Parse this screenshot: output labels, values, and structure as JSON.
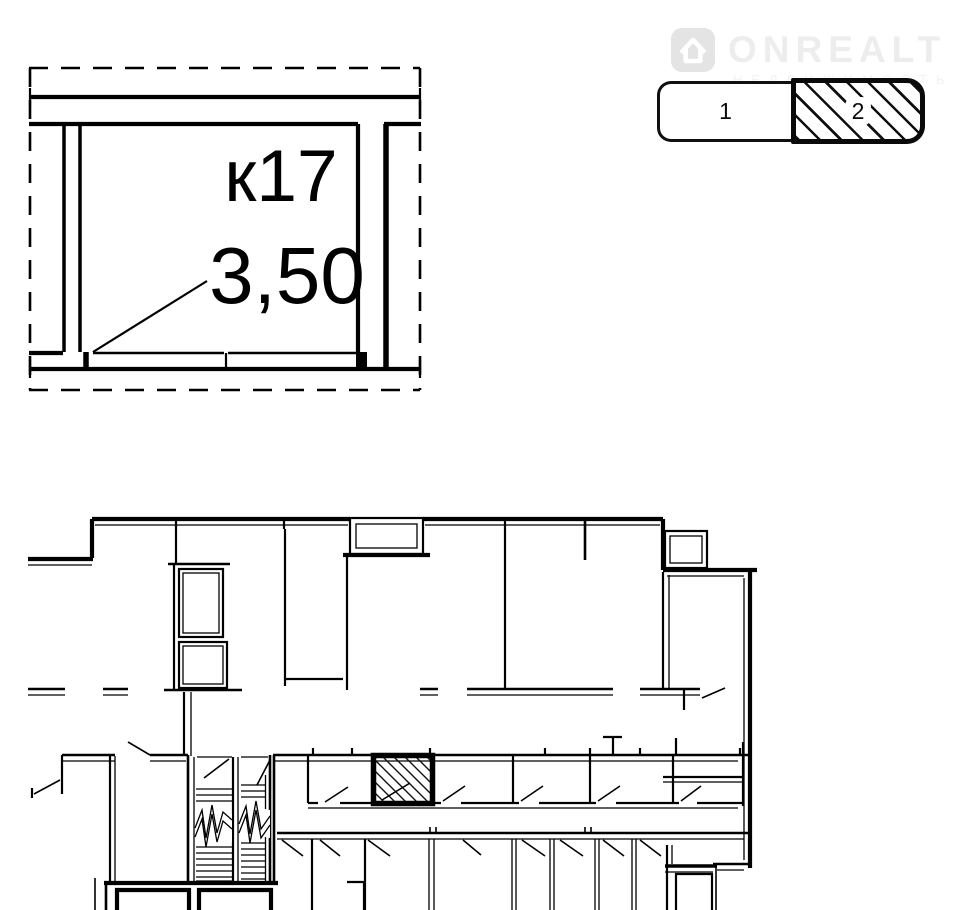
{
  "watermark": {
    "brand": "ONREALT",
    "subtitle": "НЕДВИЖИМОСТЬ",
    "icon": "house-icon"
  },
  "floor_selector": {
    "option1": {
      "label": "1",
      "selected": false
    },
    "option2": {
      "label": "2",
      "selected": true
    }
  },
  "room_detail": {
    "room_label": "к17",
    "area_label": "3,50"
  },
  "plan": {
    "line_color": "#000000",
    "background": "#ffffff",
    "hatch_color": "#111111",
    "watermark_text_color": "#ededed",
    "highlight_style": "diagonal-hatch"
  }
}
